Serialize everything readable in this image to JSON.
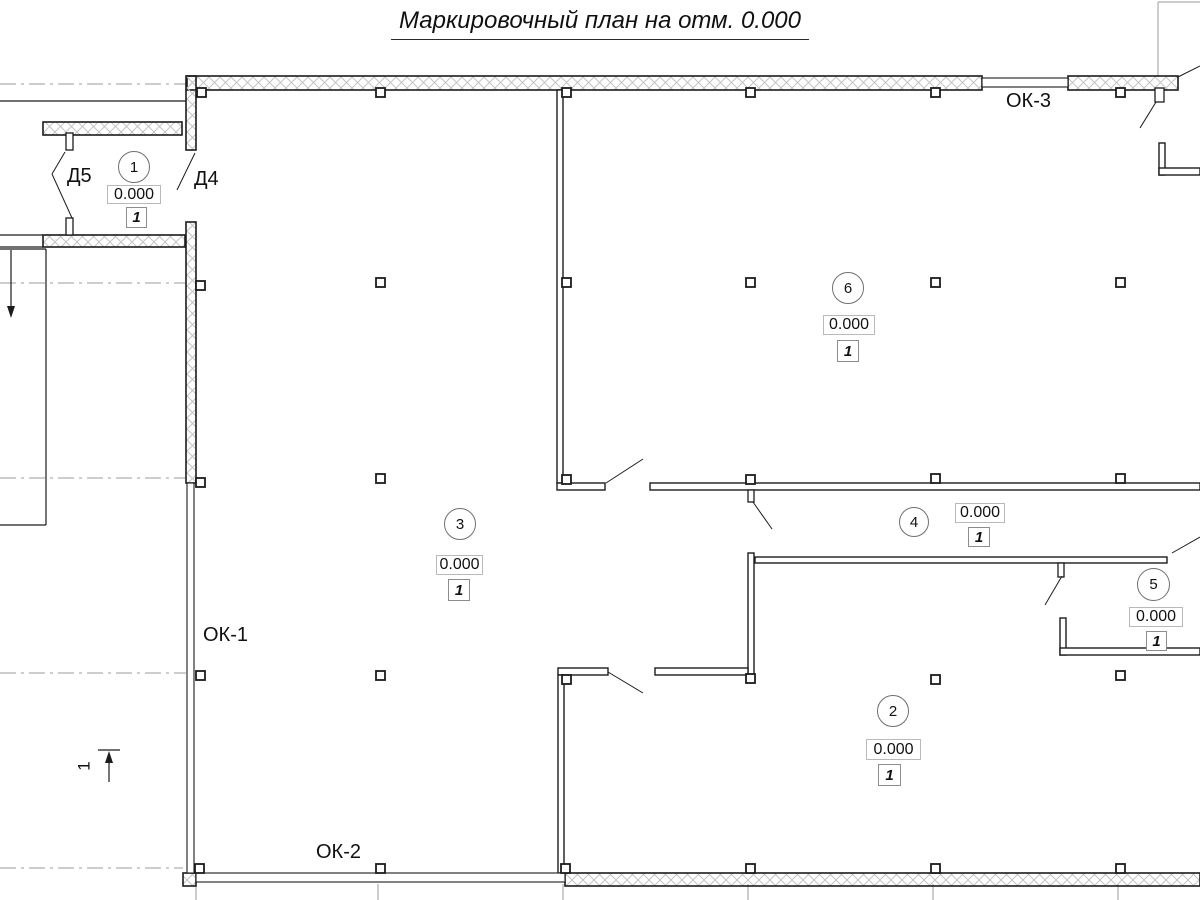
{
  "title": {
    "text": "Маркировочный план на отм. 0.000"
  },
  "colors": {
    "line": "#1c1c1c",
    "grid": "#9b9b9b",
    "hatch": "#c4c4c4",
    "box_border": "#b9b9b9",
    "flag_border": "#8d8d8d",
    "circle_border": "#6f6f6f"
  },
  "rooms": [
    {
      "number": "1",
      "elevation": "0.000",
      "flag": "1",
      "circle": {
        "x": 118,
        "y": 151,
        "w": 32,
        "h": 32
      },
      "ebox": {
        "x": 107,
        "y": 185,
        "w": 54,
        "h": 19
      },
      "fbox": {
        "x": 126,
        "y": 207,
        "w": 21,
        "h": 21
      }
    },
    {
      "number": "2",
      "elevation": "0.000",
      "flag": "1",
      "circle": {
        "x": 877,
        "y": 695,
        "w": 32,
        "h": 32
      },
      "ebox": {
        "x": 866,
        "y": 739,
        "w": 55,
        "h": 21
      },
      "fbox": {
        "x": 878,
        "y": 764,
        "w": 23,
        "h": 22
      }
    },
    {
      "number": "3",
      "elevation": "0.000",
      "flag": "1",
      "circle": {
        "x": 444,
        "y": 508,
        "w": 32,
        "h": 32
      },
      "ebox": {
        "x": 436,
        "y": 555,
        "w": 47,
        "h": 20
      },
      "fbox": {
        "x": 448,
        "y": 579,
        "w": 22,
        "h": 22
      }
    },
    {
      "number": "4",
      "elevation": "0.000",
      "flag": "1",
      "circle": {
        "x": 899,
        "y": 507,
        "w": 30,
        "h": 30
      },
      "ebox": {
        "x": 955,
        "y": 503,
        "w": 50,
        "h": 20
      },
      "fbox": {
        "x": 968,
        "y": 527,
        "w": 22,
        "h": 20
      }
    },
    {
      "number": "5",
      "elevation": "0.000",
      "flag": "1",
      "circle": {
        "x": 1137,
        "y": 568,
        "w": 33,
        "h": 33
      },
      "ebox": {
        "x": 1129,
        "y": 607,
        "w": 54,
        "h": 20
      },
      "fbox": {
        "x": 1146,
        "y": 631,
        "w": 21,
        "h": 20
      }
    },
    {
      "number": "6",
      "elevation": "0.000",
      "flag": "1",
      "circle": {
        "x": 832,
        "y": 272,
        "w": 32,
        "h": 32
      },
      "ebox": {
        "x": 823,
        "y": 315,
        "w": 52,
        "h": 20
      },
      "fbox": {
        "x": 837,
        "y": 340,
        "w": 22,
        "h": 22
      }
    }
  ],
  "window_labels": [
    {
      "text": "ОК-1",
      "pos": {
        "x": 203,
        "y": 624
      }
    },
    {
      "text": "ОК-2",
      "pos": {
        "x": 316,
        "y": 841
      }
    },
    {
      "text": "ОК-3",
      "pos": {
        "x": 1006,
        "y": 90
      }
    }
  ],
  "door_labels": [
    {
      "text": "Д5",
      "pos": {
        "x": 67,
        "y": 165
      }
    },
    {
      "text": "Д4",
      "pos": {
        "x": 194,
        "y": 168
      }
    }
  ],
  "section_mark": {
    "label": "1",
    "pos": {
      "x": 80,
      "y": 756
    }
  },
  "geometry": {
    "hatched_walls": [
      [
        187,
        76,
        795,
        14
      ],
      [
        1068,
        76,
        110,
        14
      ],
      [
        186,
        76,
        10,
        74
      ],
      [
        186,
        222,
        10,
        261
      ],
      [
        43,
        122,
        139,
        13
      ],
      [
        43,
        235,
        142,
        12
      ],
      [
        565,
        873,
        635,
        13
      ],
      [
        183,
        873,
        13,
        13
      ]
    ],
    "partitions": [
      [
        557,
        90,
        6,
        393
      ],
      [
        557,
        483,
        48,
        7
      ],
      [
        650,
        483,
        550,
        7
      ],
      [
        755,
        557,
        412,
        6
      ],
      [
        748,
        553,
        6,
        122
      ],
      [
        655,
        668,
        93,
        7
      ],
      [
        558,
        668,
        50,
        7
      ],
      [
        558,
        675,
        6,
        198
      ],
      [
        1060,
        618,
        6,
        37
      ],
      [
        1060,
        648,
        140,
        7
      ],
      [
        1159,
        143,
        6,
        32
      ],
      [
        1159,
        168,
        41,
        7
      ]
    ],
    "windows": [
      [
        982,
        78,
        86,
        9
      ],
      [
        187,
        483,
        7,
        390
      ],
      [
        196,
        873,
        369,
        9
      ]
    ],
    "columns": [
      [
        197,
        88
      ],
      [
        376,
        88
      ],
      [
        562,
        88
      ],
      [
        746,
        88
      ],
      [
        931,
        88
      ],
      [
        1116,
        88
      ],
      [
        196,
        281
      ],
      [
        376,
        278
      ],
      [
        562,
        278
      ],
      [
        746,
        278
      ],
      [
        931,
        278
      ],
      [
        1116,
        278
      ],
      [
        196,
        478
      ],
      [
        376,
        474
      ],
      [
        562,
        475
      ],
      [
        746,
        475
      ],
      [
        931,
        474
      ],
      [
        1116,
        474
      ],
      [
        196,
        671
      ],
      [
        376,
        671
      ],
      [
        562,
        675
      ],
      [
        746,
        674
      ],
      [
        931,
        675
      ],
      [
        1116,
        671
      ],
      [
        195,
        864
      ],
      [
        376,
        864
      ],
      [
        561,
        864
      ],
      [
        746,
        864
      ],
      [
        931,
        864
      ],
      [
        1116,
        864
      ]
    ],
    "column_size": 9,
    "ticks": [
      [
        66,
        133,
        7,
        17
      ],
      [
        66,
        218,
        7,
        17
      ],
      [
        1155,
        88,
        9,
        14
      ],
      [
        748,
        490,
        6,
        12
      ],
      [
        1058,
        563,
        6,
        14
      ]
    ],
    "lines": [
      [
        0,
        101,
        186,
        101
      ],
      [
        0,
        235,
        43,
        235
      ],
      [
        0,
        247,
        43,
        247
      ],
      [
        0,
        249,
        46,
        249
      ],
      [
        46,
        249,
        46,
        525
      ],
      [
        0,
        525,
        46,
        525
      ],
      [
        98,
        750,
        120,
        750
      ]
    ],
    "door_swings": [
      [
        65,
        152,
        52,
        174
      ],
      [
        52,
        174,
        72,
        218
      ],
      [
        195,
        153,
        177,
        190
      ],
      [
        606,
        483,
        643,
        459
      ],
      [
        608,
        672,
        643,
        693
      ],
      [
        753,
        502,
        772,
        529
      ],
      [
        1062,
        576,
        1045,
        605
      ],
      [
        1172,
        553,
        1200,
        537
      ],
      [
        1156,
        102,
        1140,
        128
      ],
      [
        1178,
        77,
        1200,
        66
      ]
    ],
    "axis_dashed": [
      [
        0,
        84,
        186,
        84
      ],
      [
        0,
        283,
        186,
        283
      ],
      [
        0,
        478,
        186,
        478
      ],
      [
        0,
        673,
        186,
        673
      ],
      [
        0,
        868,
        183,
        868
      ]
    ],
    "gray_lines": [
      [
        196,
        884,
        196,
        900
      ],
      [
        378,
        884,
        378,
        900
      ],
      [
        563,
        884,
        563,
        900
      ],
      [
        748,
        884,
        748,
        900
      ],
      [
        933,
        884,
        933,
        900
      ],
      [
        1118,
        884,
        1118,
        900
      ],
      [
        1158,
        2,
        1158,
        77
      ],
      [
        1158,
        2,
        1200,
        2
      ]
    ],
    "arrows": [
      {
        "line": [
          11,
          250,
          11,
          308
        ],
        "head": [
          [
            11,
            318
          ],
          [
            7,
            306
          ],
          [
            15,
            306
          ]
        ]
      },
      {
        "line": [
          109,
          782,
          109,
          756
        ],
        "head": [
          [
            109,
            751
          ],
          [
            105,
            763
          ],
          [
            113,
            763
          ]
        ]
      }
    ]
  }
}
